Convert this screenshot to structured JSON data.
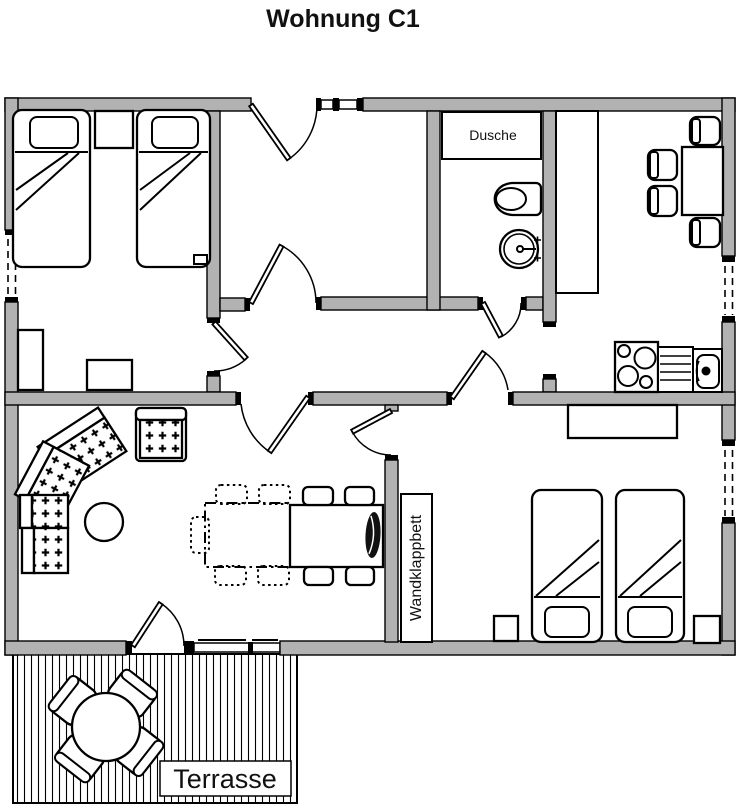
{
  "title": "Wohnung C1",
  "labels": {
    "shower": "Dusche",
    "wall_bed": "Wandklappbett",
    "terrace": "Terrasse"
  },
  "colors": {
    "wall": "#b2b2b2",
    "line": "#000000",
    "bg": "#ffffff"
  },
  "rooms": {
    "bedroom_top": {
      "items": [
        "single-bed",
        "single-bed",
        "nightstand",
        "wardrobe",
        "dresser",
        "wall-shelf",
        "window"
      ]
    },
    "hallway": {
      "items": [
        "entry-door",
        "sidelight-window"
      ]
    },
    "bathroom": {
      "items": [
        "shower",
        "toilet",
        "washbasin"
      ]
    },
    "kitchen": {
      "items": [
        "counter",
        "dining-table",
        "chair",
        "chair",
        "chair",
        "chair",
        "stove",
        "drainboard",
        "sink",
        "window"
      ]
    },
    "living_room": {
      "items": [
        "corner-sofa",
        "armchair",
        "coffee-table",
        "dining-table",
        "table-extension",
        "chair",
        "chair",
        "chair",
        "chair",
        "folded-chair",
        "terrace-door",
        "window"
      ]
    },
    "bedroom_bottom": {
      "items": [
        "wall-folding-bed",
        "single-bed",
        "single-bed",
        "nightstand",
        "nightstand",
        "dresser",
        "window"
      ]
    },
    "terrace": {
      "items": [
        "round-table",
        "chair",
        "chair",
        "chair",
        "chair"
      ]
    }
  }
}
